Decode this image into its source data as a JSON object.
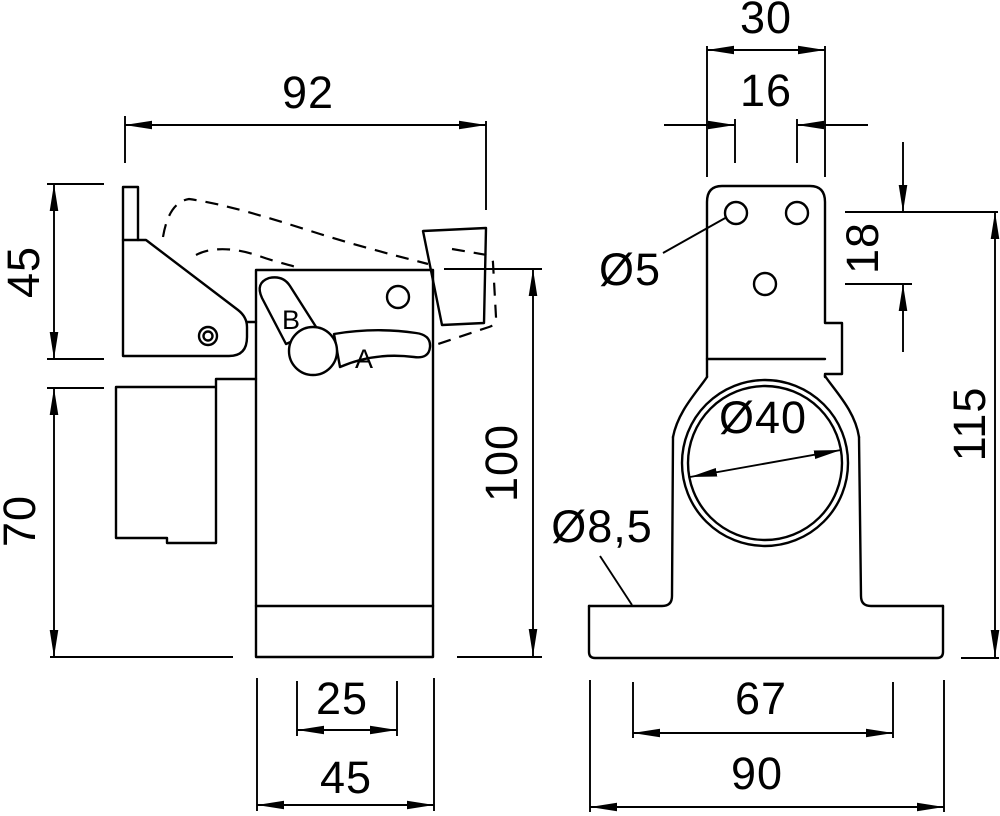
{
  "drawing": {
    "background": "#ffffff",
    "line_color": "#000000",
    "views": {
      "side": {
        "dims": {
          "top_width": "92",
          "upper_height": "45",
          "lower_height": "70",
          "right_height": "100",
          "slot_width": "25",
          "bottom_width": "45"
        },
        "labels": {
          "lever_pos_a": "A",
          "lever_pos_b": "B"
        }
      },
      "front": {
        "dims": {
          "top_width": "30",
          "hole_pitch": "16",
          "hole_dia": "Ø5",
          "hole_row_offset": "18",
          "ring_bore": "Ø40",
          "base_hole_dia": "Ø8,5",
          "total_height": "115",
          "base_hole_pitch": "67",
          "base_width": "90"
        }
      }
    }
  }
}
